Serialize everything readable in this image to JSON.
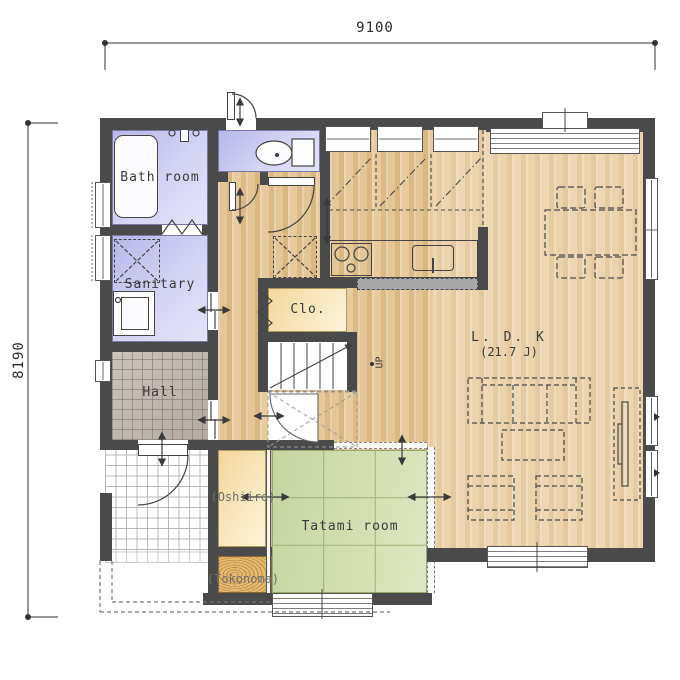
{
  "plan": {
    "dimension_top": "9100",
    "dimension_left": "8190",
    "rooms": {
      "bath": "Bath room",
      "sanitary": "Sanitary",
      "hall": "Hall",
      "closet": "Clo.",
      "stairs_up": "UP",
      "oshiire": "(Oshiire)",
      "tatami": "Tatami room",
      "tokonoma": "(Tokonoma)",
      "ldk_name": "L. D. K",
      "ldk_size": "(21.7 J)"
    },
    "colors": {
      "wall": "#4a4a4a",
      "wet_room": "#c9c9ef",
      "wood_floor": "#e0be8c",
      "tatami_green": "#cdd9a8",
      "closet_cream": "#f5dfa8",
      "hall_tile": "#b8b0a6",
      "tokonoma_wood": "#e2b369"
    }
  }
}
